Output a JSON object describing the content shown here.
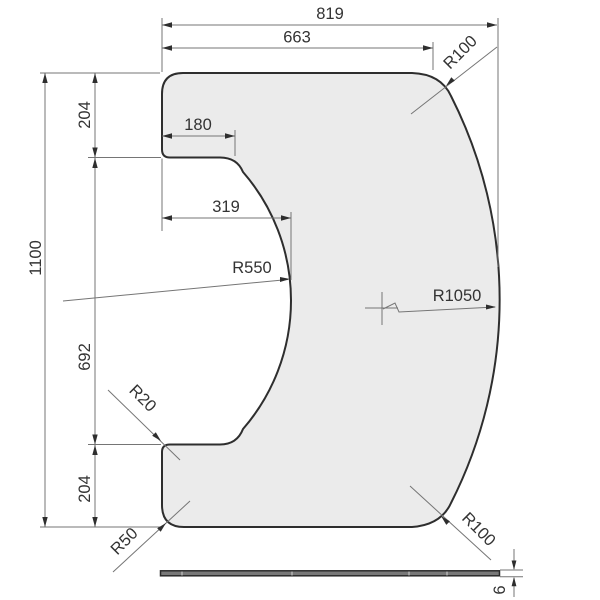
{
  "drawing": {
    "type": "technical-dimension-drawing",
    "views": {
      "top_view": "shaped panel with concave left cutout",
      "side_view": "thin edge profile strip"
    },
    "colors": {
      "background": "#ffffff",
      "panel_fill": "#ebebeb",
      "outline": "#2e2e2e",
      "dimension_lines": "#757575",
      "text": "#333333"
    },
    "dims": {
      "overall_width": "819",
      "upper_width": "663",
      "tab_width": "180",
      "cutout_depth": "319",
      "cutout_radius": "R550",
      "side_radius": "R1050",
      "overall_height": "1100",
      "top_section_height": "204",
      "middle_section_height": "692",
      "bottom_section_height": "204",
      "step_radius": "R20",
      "corner_radius": "R50",
      "top_right_radius": "R100",
      "bottom_right_radius": "R100",
      "thickness": "6"
    }
  }
}
